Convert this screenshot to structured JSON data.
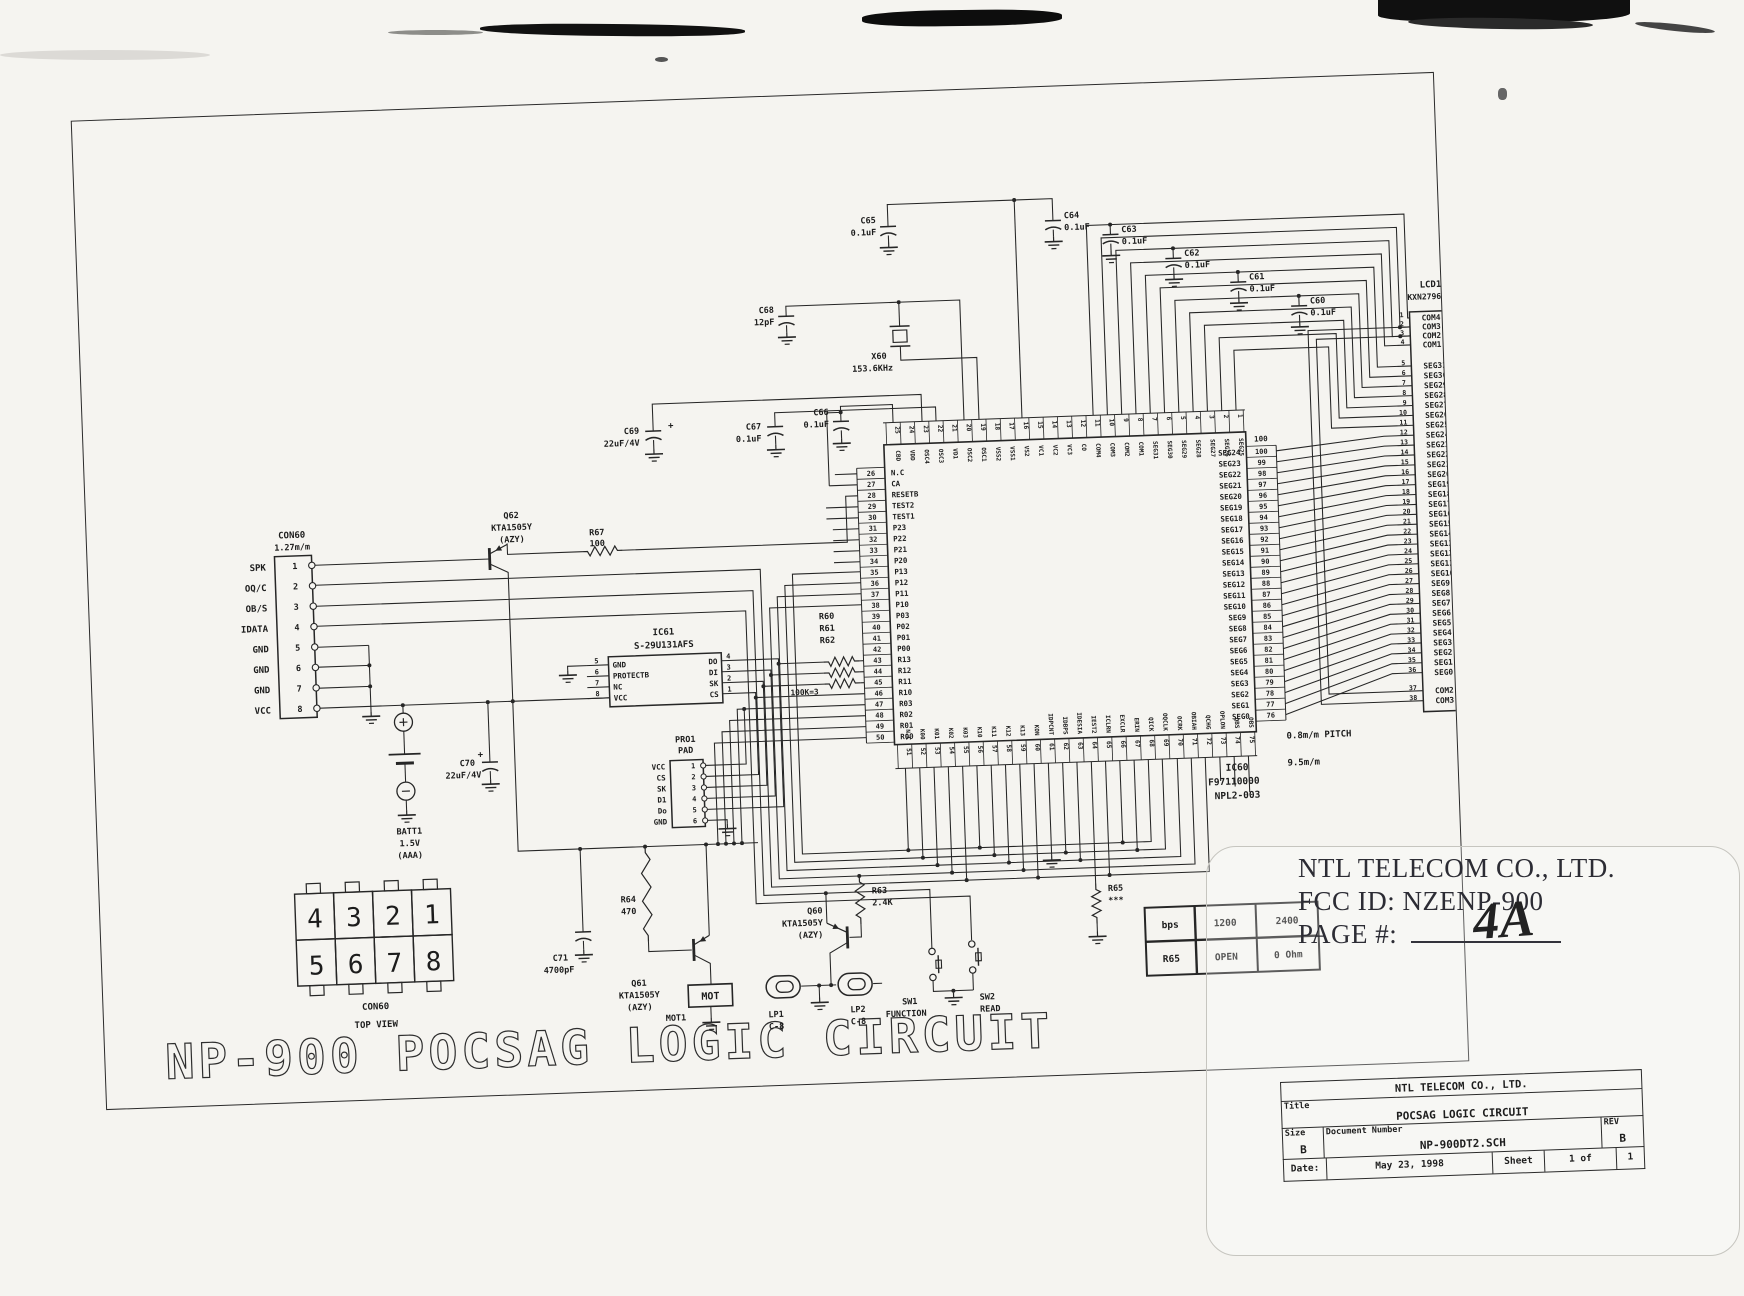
{
  "big_title": "NP-900 POCSAG LOGIC CIRCUIT",
  "stamp": {
    "company": "NTL TELECOM CO., LTD.",
    "fcc_line": "FCC ID:  NZENP-900",
    "page_label": "PAGE #:",
    "page_value": "4A"
  },
  "title_block": {
    "company": "NTL TELECOM CO., LTD.",
    "title_label": "Title",
    "title": "POCSAG LOGIC CIRCUIT",
    "size_label": "Size",
    "size": "B",
    "doc_label": "Document Number",
    "doc": "NP-900DT2.SCH",
    "rev_label": "REV",
    "rev": "B",
    "date_label": "Date:",
    "date": "May 23, 1998",
    "sheet_label": "Sheet",
    "sheet": "1 of",
    "sheet_total": "1"
  },
  "bps_table": {
    "rows": [
      [
        "bps",
        "1200",
        "2400"
      ],
      [
        "R65",
        "OPEN",
        "0 Ohm"
      ]
    ]
  },
  "lcd": {
    "ref": "LCD1",
    "part": "KXN27960CEP",
    "pitch": "0.8m/m PITCH",
    "width": "9.5m/m",
    "pins": [
      {
        "n": "1",
        "l": "COM4"
      },
      {
        "n": "2",
        "l": "COM3"
      },
      {
        "n": "3",
        "l": "COM2"
      },
      {
        "n": "4",
        "l": "COM1"
      },
      {
        "n": "5",
        "l": "SEG31"
      },
      {
        "n": "6",
        "l": "SEG30"
      },
      {
        "n": "7",
        "l": "SEG29"
      },
      {
        "n": "8",
        "l": "SEG28"
      },
      {
        "n": "9",
        "l": "SEG27"
      },
      {
        "n": "10",
        "l": "SEG26"
      },
      {
        "n": "11",
        "l": "SEG25"
      },
      {
        "n": "12",
        "l": "SEG24"
      },
      {
        "n": "13",
        "l": "SEG23"
      },
      {
        "n": "14",
        "l": "SEG22"
      },
      {
        "n": "15",
        "l": "SEG21"
      },
      {
        "n": "16",
        "l": "SEG20"
      },
      {
        "n": "17",
        "l": "SEG19"
      },
      {
        "n": "18",
        "l": "SEG18"
      },
      {
        "n": "19",
        "l": "SEG17"
      },
      {
        "n": "20",
        "l": "SEG16"
      },
      {
        "n": "21",
        "l": "SEG15"
      },
      {
        "n": "22",
        "l": "SEG14"
      },
      {
        "n": "23",
        "l": "SEG13"
      },
      {
        "n": "24",
        "l": "SEG12"
      },
      {
        "n": "25",
        "l": "SEG11"
      },
      {
        "n": "26",
        "l": "SEG10"
      },
      {
        "n": "27",
        "l": "SEG9"
      },
      {
        "n": "28",
        "l": "SEG8"
      },
      {
        "n": "29",
        "l": "SEG7"
      },
      {
        "n": "30",
        "l": "SEG6"
      },
      {
        "n": "31",
        "l": "SEG5"
      },
      {
        "n": "32",
        "l": "SEG4"
      },
      {
        "n": "33",
        "l": "SEG3"
      },
      {
        "n": "34",
        "l": "SEG2"
      },
      {
        "n": "35",
        "l": "SEG1"
      },
      {
        "n": "36",
        "l": "SEG0"
      },
      {
        "n": "37",
        "l": "COM2"
      },
      {
        "n": "38",
        "l": "COM3"
      }
    ]
  },
  "ic60": {
    "ref": "IC60",
    "part": "F97110000",
    "board": "NPL2-003",
    "pin100_label": "100",
    "left": [
      {
        "n": "26",
        "l": "N.C"
      },
      {
        "n": "27",
        "l": "CA"
      },
      {
        "n": "28",
        "l": "RESETB"
      },
      {
        "n": "29",
        "l": "TEST2"
      },
      {
        "n": "30",
        "l": "TEST1"
      },
      {
        "n": "31",
        "l": "P23"
      },
      {
        "n": "32",
        "l": "P22"
      },
      {
        "n": "33",
        "l": "P21"
      },
      {
        "n": "34",
        "l": "P20"
      },
      {
        "n": "35",
        "l": "P13"
      },
      {
        "n": "36",
        "l": "P12"
      },
      {
        "n": "37",
        "l": "P11"
      },
      {
        "n": "38",
        "l": "P10"
      },
      {
        "n": "39",
        "l": "P03"
      },
      {
        "n": "40",
        "l": "P02"
      },
      {
        "n": "41",
        "l": "P01"
      },
      {
        "n": "42",
        "l": "P00"
      },
      {
        "n": "43",
        "l": "R13"
      },
      {
        "n": "44",
        "l": "R12"
      },
      {
        "n": "45",
        "l": "R11"
      },
      {
        "n": "46",
        "l": "R10"
      },
      {
        "n": "47",
        "l": "R03"
      },
      {
        "n": "48",
        "l": "R02"
      },
      {
        "n": "49",
        "l": "R01"
      },
      {
        "n": "50",
        "l": "R00"
      }
    ],
    "top": [
      {
        "n": "25",
        "l": "CBD"
      },
      {
        "n": "24",
        "l": "VDD"
      },
      {
        "n": "23",
        "l": "OSC4"
      },
      {
        "n": "22",
        "l": "OSC3"
      },
      {
        "n": "21",
        "l": "VD1"
      },
      {
        "n": "20",
        "l": "OSC2"
      },
      {
        "n": "19",
        "l": "OSC1"
      },
      {
        "n": "18",
        "l": "VSS2"
      },
      {
        "n": "17",
        "l": "VSS1"
      },
      {
        "n": "16",
        "l": "VS2"
      },
      {
        "n": "15",
        "l": "VC1"
      },
      {
        "n": "14",
        "l": "VC2"
      },
      {
        "n": "13",
        "l": "VC3"
      },
      {
        "n": "12",
        "l": "CO"
      },
      {
        "n": "11",
        "l": "COM4"
      },
      {
        "n": "10",
        "l": "COM3"
      },
      {
        "n": "9",
        "l": "COM2"
      },
      {
        "n": "8",
        "l": "COM1"
      },
      {
        "n": "7",
        "l": "SEG31"
      },
      {
        "n": "6",
        "l": "SEG30"
      },
      {
        "n": "5",
        "l": "SEG29"
      },
      {
        "n": "4",
        "l": "SEG28"
      },
      {
        "n": "3",
        "l": "SEG27"
      },
      {
        "n": "2",
        "l": "SEG26"
      },
      {
        "n": "1",
        "l": "SEG25"
      }
    ],
    "right": [
      {
        "n": "100",
        "l": "SEG24"
      },
      {
        "n": "99",
        "l": "SEG23"
      },
      {
        "n": "98",
        "l": "SEG22"
      },
      {
        "n": "97",
        "l": "SEG21"
      },
      {
        "n": "96",
        "l": "SEG20"
      },
      {
        "n": "95",
        "l": "SEG19"
      },
      {
        "n": "94",
        "l": "SEG18"
      },
      {
        "n": "93",
        "l": "SEG17"
      },
      {
        "n": "92",
        "l": "SEG16"
      },
      {
        "n": "91",
        "l": "SEG15"
      },
      {
        "n": "90",
        "l": "SEG14"
      },
      {
        "n": "89",
        "l": "SEG13"
      },
      {
        "n": "88",
        "l": "SEG12"
      },
      {
        "n": "87",
        "l": "SEG11"
      },
      {
        "n": "86",
        "l": "SEG10"
      },
      {
        "n": "85",
        "l": "SEG9"
      },
      {
        "n": "84",
        "l": "SEG8"
      },
      {
        "n": "83",
        "l": "SEG7"
      },
      {
        "n": "82",
        "l": "SEG6"
      },
      {
        "n": "81",
        "l": "SEG5"
      },
      {
        "n": "80",
        "l": "SEG4"
      },
      {
        "n": "79",
        "l": "SEG3"
      },
      {
        "n": "78",
        "l": "SEG2"
      },
      {
        "n": "77",
        "l": "SEG1"
      },
      {
        "n": "76",
        "l": "SEG0"
      }
    ],
    "bottom": [
      {
        "n": "51",
        "l": "N.C"
      },
      {
        "n": "52",
        "l": "K00"
      },
      {
        "n": "53",
        "l": "K01"
      },
      {
        "n": "54",
        "l": "K02"
      },
      {
        "n": "55",
        "l": "K03"
      },
      {
        "n": "56",
        "l": "K10"
      },
      {
        "n": "57",
        "l": "K11"
      },
      {
        "n": "58",
        "l": "K12"
      },
      {
        "n": "59",
        "l": "K13"
      },
      {
        "n": "60",
        "l": "KON"
      },
      {
        "n": "61",
        "l": "IDPCNT"
      },
      {
        "n": "62",
        "l": "IDBPS"
      },
      {
        "n": "63",
        "l": "IDESIA"
      },
      {
        "n": "64",
        "l": "IEST2"
      },
      {
        "n": "65",
        "l": "ICLRN"
      },
      {
        "n": "66",
        "l": "EXCLR"
      },
      {
        "n": "67",
        "l": "ERIN"
      },
      {
        "n": "68",
        "l": "QICK"
      },
      {
        "n": "69",
        "l": "OQCLK"
      },
      {
        "n": "70",
        "l": "OCRK"
      },
      {
        "n": "71",
        "l": "OBIAH"
      },
      {
        "n": "72",
        "l": "QCHG"
      },
      {
        "n": "73",
        "l": "OPLON"
      },
      {
        "n": "74",
        "l": "QBS"
      },
      {
        "n": "75",
        "l": "OBS"
      }
    ]
  },
  "con60": {
    "ref": "CON60",
    "pitch": "1.27m/m",
    "pins": [
      {
        "n": "1",
        "l": "SPK"
      },
      {
        "n": "2",
        "l": "OQ/C"
      },
      {
        "n": "3",
        "l": "OB/S"
      },
      {
        "n": "4",
        "l": "IDATA"
      },
      {
        "n": "5",
        "l": "GND"
      },
      {
        "n": "6",
        "l": "GND"
      },
      {
        "n": "7",
        "l": "GND"
      },
      {
        "n": "8",
        "l": "VCC"
      }
    ]
  },
  "ic61": {
    "ref": "IC61",
    "part": "S-29U131AFS",
    "left": [
      {
        "n": "5",
        "l": "GND"
      },
      {
        "n": "6",
        "l": "PROTECTB"
      },
      {
        "n": "7",
        "l": "NC"
      },
      {
        "n": "8",
        "l": "VCC"
      }
    ],
    "right": [
      {
        "n": "4",
        "l": "DO"
      },
      {
        "n": "3",
        "l": "DI"
      },
      {
        "n": "2",
        "l": "SK"
      },
      {
        "n": "1",
        "l": "CS"
      }
    ]
  },
  "pro1": {
    "ref": "PRO1",
    "sub": "PAD",
    "pins": [
      {
        "n": "1",
        "l": "VCC"
      },
      {
        "n": "2",
        "l": "CS"
      },
      {
        "n": "3",
        "l": "SK"
      },
      {
        "n": "4",
        "l": "D1"
      },
      {
        "n": "5",
        "l": "Do"
      },
      {
        "n": "6",
        "l": "GND"
      }
    ]
  },
  "dip": {
    "ref": "CON60",
    "view": "TOP VIEW",
    "top": [
      "4",
      "3",
      "2",
      "1"
    ],
    "bottom": [
      "5",
      "6",
      "7",
      "8"
    ]
  },
  "batt": {
    "ref": "BATT1",
    "v": "1.5V",
    "type": "(AAA)"
  },
  "components": {
    "c65": {
      "ref": "C65",
      "val": "0.1uF"
    },
    "c64": {
      "ref": "C64",
      "val": "0.1uF"
    },
    "c63": {
      "ref": "C63",
      "val": "0.1uF"
    },
    "c62": {
      "ref": "C62",
      "val": "0.1uF"
    },
    "c61": {
      "ref": "C61",
      "val": "0.1uF"
    },
    "c60": {
      "ref": "C60",
      "val": "0.1uF"
    },
    "c66": {
      "ref": "C66",
      "val": "0.1uF"
    },
    "c67": {
      "ref": "C67",
      "val": "0.1uF"
    },
    "c68": {
      "ref": "C68",
      "val": "12pF"
    },
    "c69": {
      "ref": "C69",
      "val": "22uF/4V"
    },
    "c70": {
      "ref": "C70",
      "val": "22uF/4V"
    },
    "c71": {
      "ref": "C71",
      "val": "4700pF"
    },
    "x60": {
      "ref": "X60",
      "val": "153.6KHz"
    },
    "r67": {
      "ref": "R67",
      "val": "100"
    },
    "r63": {
      "ref": "R63",
      "val": "2.4K"
    },
    "r64": {
      "ref": "R64",
      "val": "470"
    },
    "r65": {
      "ref": "R65",
      "val": "***"
    },
    "rbank": {
      "r60": "R60",
      "r61": "R61",
      "r62": "R62",
      "val": "100K=3"
    },
    "q60": {
      "ref": "Q60",
      "part": "KTA1505Y",
      "pkg": "(AZY)"
    },
    "q61": {
      "ref": "Q61",
      "part": "KTA1505Y",
      "pkg": "(AZY)"
    },
    "q62": {
      "ref": "Q62",
      "part": "KTA1505Y",
      "pkg": "(AZY)"
    },
    "mot": {
      "box": "MOT",
      "ref": "MOT1"
    },
    "lp1": {
      "ref": "LP1",
      "val": "C-8"
    },
    "lp2": {
      "ref": "LP2",
      "val": "C-8"
    },
    "sw1": {
      "ref": "SW1",
      "val": "FUNCTION"
    },
    "sw2": {
      "ref": "SW2",
      "val": "READ"
    }
  }
}
